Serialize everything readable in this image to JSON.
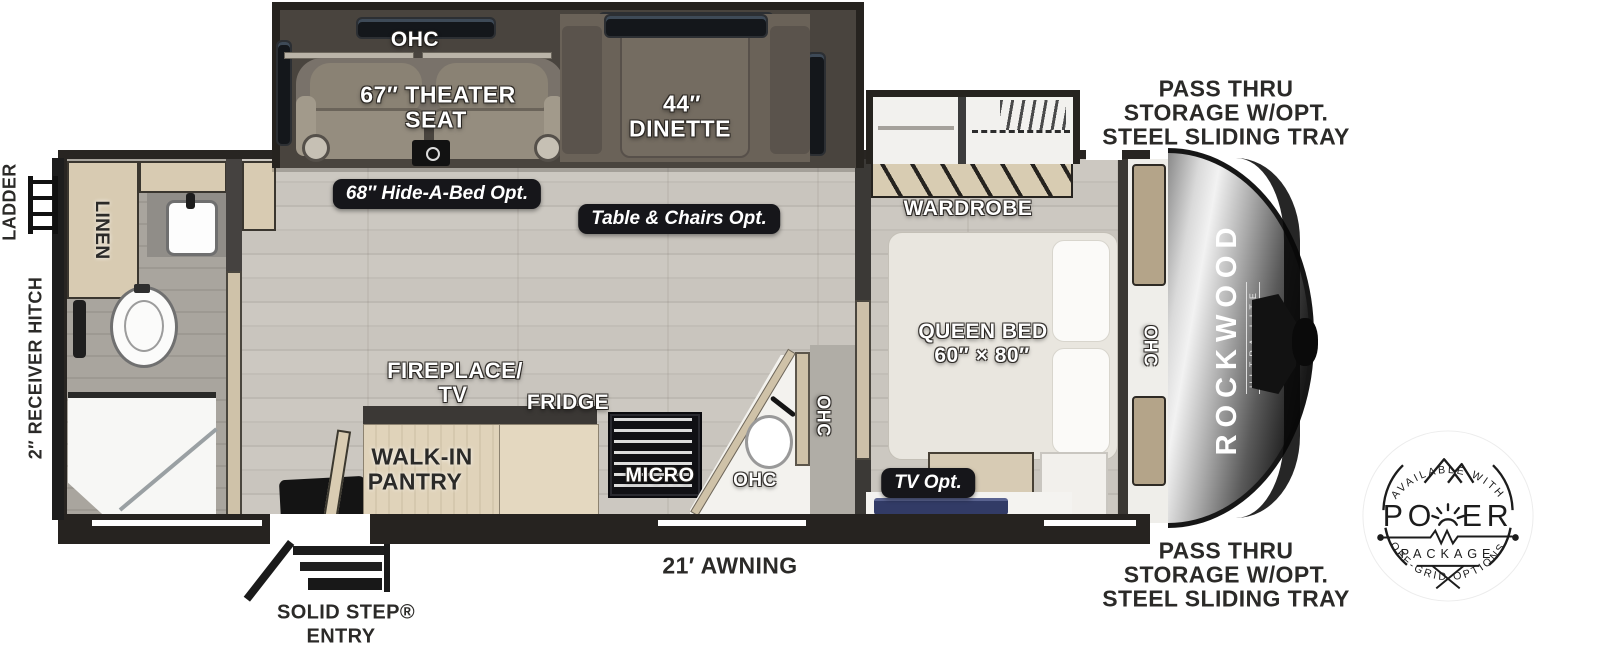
{
  "exterior": {
    "ladder_label": "LADDER",
    "receiver_hitch_label": "2″ RECEIVER HITCH",
    "awning_label": "21′ AWNING",
    "entry_label_line1": "SOLID STEP®",
    "entry_label_line2": "ENTRY",
    "pass_thru_top": [
      "PASS THRU",
      "STORAGE W/OPT.",
      "STEEL SLIDING TRAY"
    ],
    "pass_thru_bottom": [
      "PASS THRU",
      "STORAGE W/OPT.",
      "STEEL SLIDING TRAY"
    ]
  },
  "slide_out": {
    "ohc_label": "OHC",
    "theater_line1": "67″ THEATER",
    "theater_line2": "SEAT",
    "hide_a_bed_pill": "68″ Hide-A-Bed Opt.",
    "dinette_line1": "44″",
    "dinette_line2": "DINETTE",
    "table_chairs_pill": "Table & Chairs Opt."
  },
  "bathroom": {
    "linen_label": "LINEN"
  },
  "kitchen": {
    "fireplace_line1": "FIREPLACE/",
    "fireplace_line2": "TV",
    "fridge_label": "FRIDGE",
    "pantry_line1": "WALK-IN",
    "pantry_line2": "PANTRY",
    "micro_label": "MICRO",
    "ohc_lower_label": "OHC",
    "ohc_side_label": "OHC"
  },
  "bedroom": {
    "wardrobe_label": "WARDROBE",
    "bed_line1": "QUEEN BED",
    "bed_line2": "60″ × 80″",
    "tv_pill": "TV Opt.",
    "ohc_front_label": "OHC"
  },
  "brand": {
    "name": "ROCKWOOD",
    "sub": "ULTRA LITE"
  },
  "badge": {
    "arc_top": "AVAILABLE WITH",
    "power_left": "PO",
    "power_right": "ER",
    "package": "PACKAGE",
    "arc_bottom": "OFF-GRID OPTIONS"
  },
  "colors": {
    "wall": "#282522",
    "floor": "#c8c4bd",
    "slide_interior": "#49443e",
    "cabinet_wood": "#d8cbb2",
    "pill_bg": "#16161a",
    "badge_ink": "#1c1c1c",
    "bed": "#e9e6df",
    "tv_accent": "#323b66"
  }
}
